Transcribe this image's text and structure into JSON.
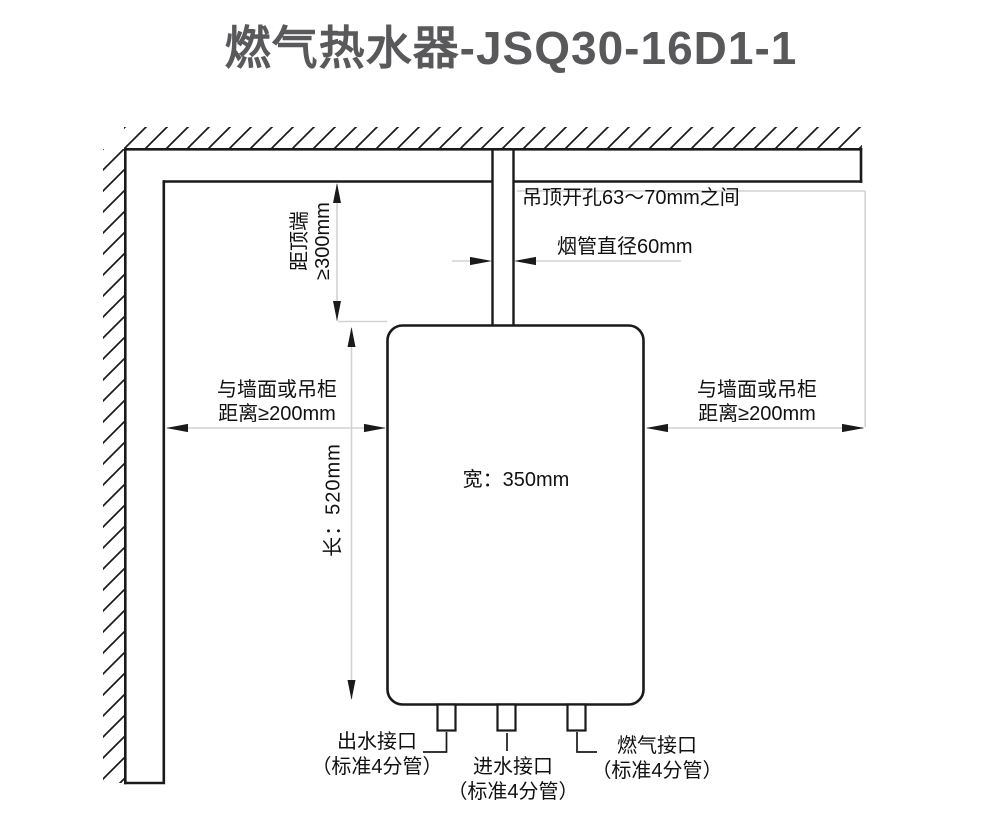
{
  "title": "燃气热水器-JSQ30-16D1-1",
  "colors": {
    "line": "#1a1a1a",
    "dimension_line": "#d2d2d2",
    "title_text": "#59595b",
    "annotation_text": "#111111",
    "background": "#ffffff"
  },
  "labels": {
    "top_clearance": {
      "line1": "距顶端",
      "line2": "≥300mm"
    },
    "ceiling_hole": "吊顶开孔63～70mm之间",
    "flue_diameter": "烟管直径60mm",
    "left_clearance": {
      "line1": "与墙面或吊柜",
      "line2": "距离≥200mm"
    },
    "right_clearance": {
      "line1": "与墙面或吊柜",
      "line2": "距离≥200mm"
    },
    "body_width": "宽：350mm",
    "body_length": "长：520mm",
    "water_outlet": {
      "line1": "出水接口",
      "line2": "（标准4分管）"
    },
    "water_inlet": {
      "line1": "进水接口",
      "line2": "（标准4分管）"
    },
    "gas_inlet": {
      "line1": "燃气接口",
      "line2": "（标准4分管）"
    }
  }
}
